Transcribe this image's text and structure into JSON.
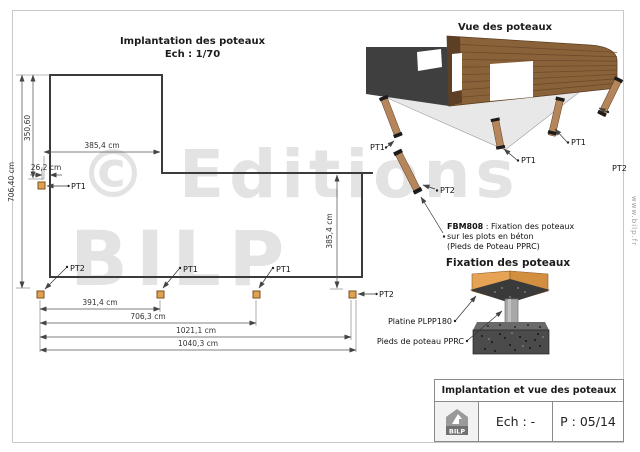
{
  "plan": {
    "title": "Implantation des poteaux",
    "scale": "Ech : 1/70",
    "dims": {
      "top_width": "385,4 cm",
      "left_upper": "350,60",
      "left_total": "706,40 cm",
      "post_offset": "26,2 cm",
      "right_depth": "385,4 cm",
      "chain_1": "391,4 cm",
      "chain_2": "706,3 cm",
      "chain_3": "1021,1 cm",
      "chain_4": "1040,3 cm"
    },
    "post_labels": {
      "top_left": "PT1",
      "bottom_1": "PT2",
      "bottom_2": "PT1",
      "bottom_3": "PT1",
      "bottom_right": "PT2"
    }
  },
  "view3d": {
    "title": "Vue des poteaux",
    "post_labels": {
      "left": "PT1",
      "front_left": "PT2",
      "center": "PT1",
      "right": "PT1",
      "far_right": "PT2"
    },
    "note": {
      "code": "FBM808",
      "line1_rest": " : Fixation des poteaux",
      "line2": "sur les plots en béton",
      "line3": "(Pieds de Poteau PPRC)"
    }
  },
  "fixation": {
    "title": "Fixation des poteaux",
    "plate_label": "Platine PLPP180",
    "foot_label": "Pieds de poteau PPRC"
  },
  "title_block": {
    "title": "Implantation et vue des poteaux",
    "logo_text": "BILP",
    "scale": "Ech : -",
    "page": "P : 05/14"
  },
  "watermark": {
    "line1": "© Editions",
    "line2": "BILP",
    "website": "www.bilp.fr"
  },
  "colors": {
    "post_fill": "#e2a14f",
    "wood": "#8a6239",
    "dark_wall": "#3f3f3f",
    "slab": "#e8e8e8",
    "concrete": "#4b4b4b",
    "watermark": "#e3e3e3"
  }
}
